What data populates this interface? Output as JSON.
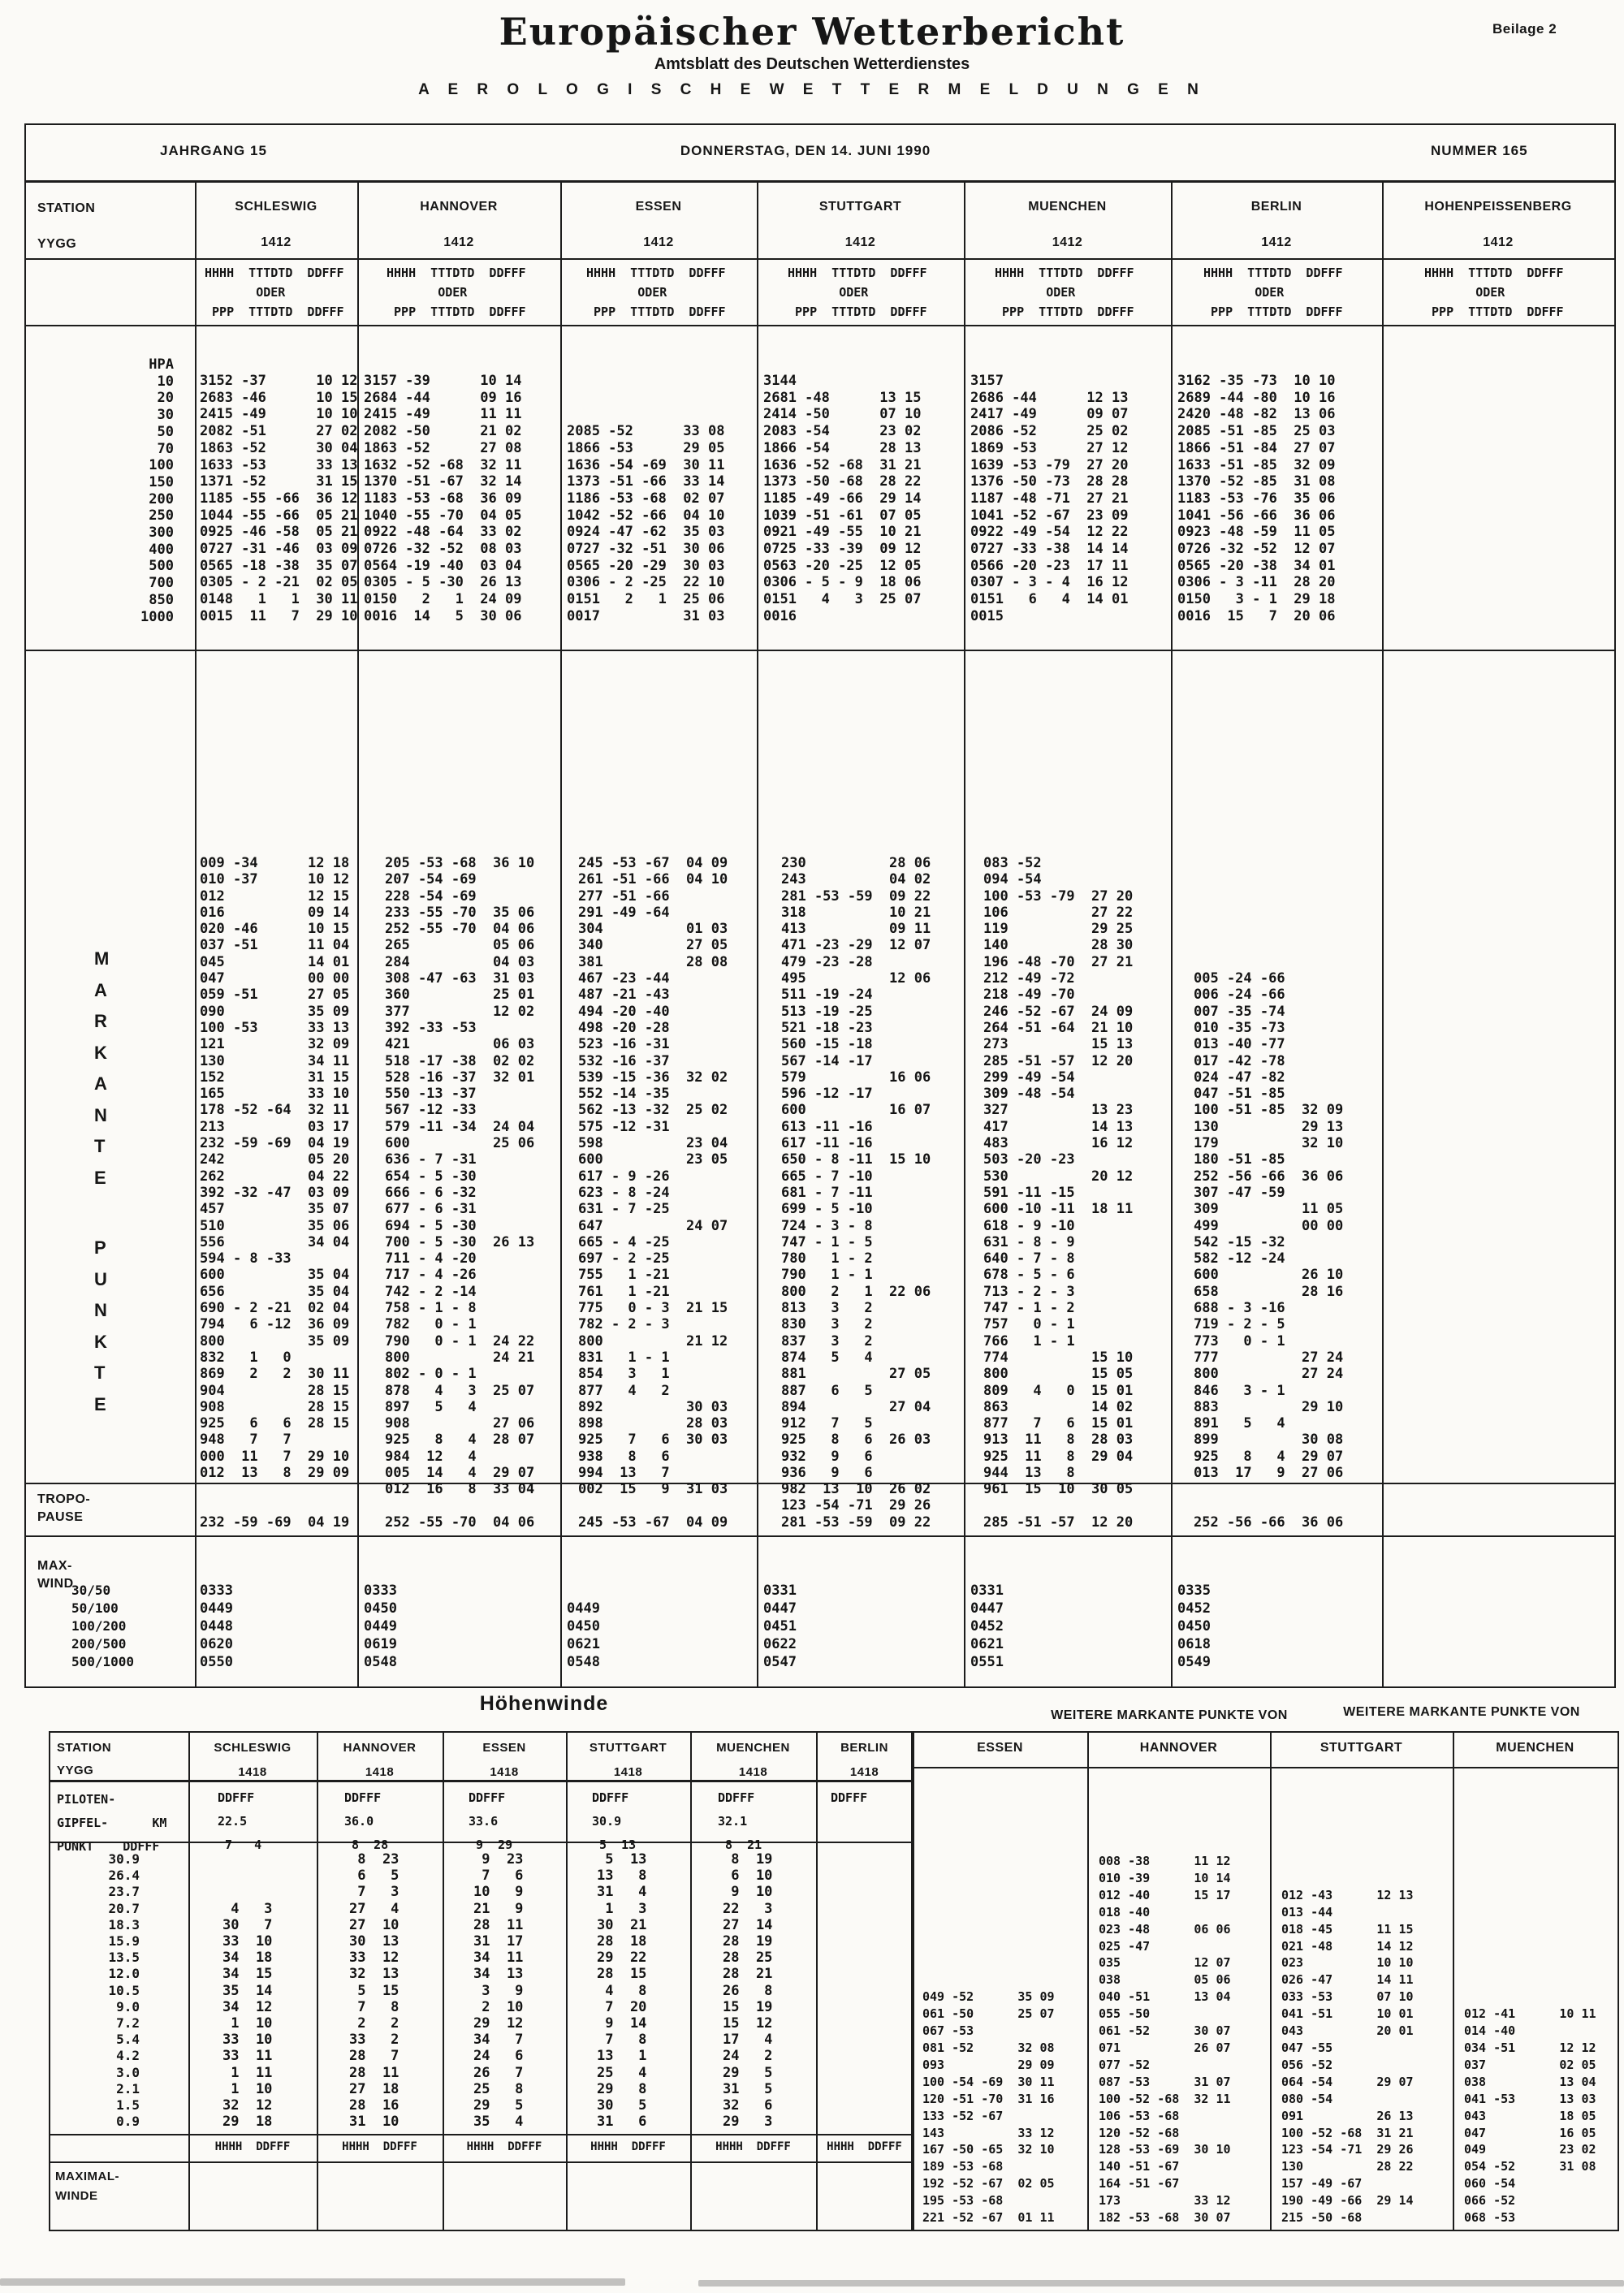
{
  "header": {
    "title": "Europäischer Wetterbericht",
    "subtitle": "Amtsblatt des Deutschen Wetterdienstes",
    "tagline": "A E R O L O G I S C H E   W E T T E R M E L D U N G E N",
    "beilage": "Beilage 2",
    "jahrgang": "JAHRGANG 15",
    "date": "DONNERSTAG, DEN 14. JUNI 1990",
    "nummer": "NUMMER 165"
  },
  "upper": {
    "station_label": "STATION",
    "yygg_label": "YYGG",
    "subheader_lines": [
      "HHHH  TTTDTD  DDFFF",
      "       ODER",
      " PPP  TTTDTD  DDFFF"
    ],
    "left_levels": [
      "HPA",
      "10",
      "20",
      "30",
      "50",
      "70",
      "100",
      "150",
      "200",
      "250",
      "300",
      "400",
      "500",
      "700",
      "850",
      "1000"
    ],
    "markante_letters_1": [
      "M",
      "A",
      "R",
      "K",
      "A",
      "N",
      "T",
      "E"
    ],
    "markante_letters_2": [
      "P",
      "U",
      "N",
      "K",
      "T",
      "E"
    ],
    "tropo_label_1": "TROPO-",
    "tropo_label_2": "PAUSE",
    "maxwind_label_1": "MAX-",
    "maxwind_label_2": "WIND",
    "maxwind_levels": [
      "30/50",
      "50/100",
      "100/200",
      "200/500",
      "500/1000"
    ],
    "stations": [
      {
        "name": "SCHLESWIG",
        "yygg": "1412",
        "hpa": [
          "3152 -37      10 12",
          "2683 -46      10 15",
          "2415 -49      10 10",
          "2082 -51      27 02",
          "1863 -52      30 04",
          "1633 -53      33 13",
          "1371 -52      31 15",
          "1185 -55 -66  36 12",
          "1044 -55 -66  05 21",
          "0925 -46 -58  05 21",
          "0727 -31 -46  03 09",
          "0565 -18 -38  35 07",
          "0305 - 2 -21  02 05",
          "0148   1   1  30 11",
          "0015  11   7  29 10"
        ],
        "markante": [
          "009 -34      12 18",
          "010 -37      10 12",
          "012          12 15",
          "016          09 14",
          "020 -46      10 15",
          "037 -51      11 04",
          "045          14 01",
          "047          00 00",
          "059 -51      27 05",
          "090          35 09",
          "100 -53      33 13",
          "121          32 09",
          "130          34 11",
          "152          31 15",
          "165          33 10",
          "178 -52 -64  32 11",
          "213          03 17",
          "232 -59 -69  04 19",
          "242          05 20",
          "262          04 22",
          "392 -32 -47  03 09",
          "457          35 07",
          "510          35 06",
          "556          34 04",
          "594 - 8 -33",
          "600          35 04",
          "656          35 04",
          "690 - 2 -21  02 04",
          "794   6 -12  36 09",
          "800          35 09",
          "832   1   0",
          "869   2   2  30 11",
          "904          28 15",
          "908          28 15",
          "925   6   6  28 15",
          "948   7   7",
          "000  11   7  29 10",
          "012  13   8  29 09"
        ],
        "tropo": [
          "",
          "232 -59 -69  04 19"
        ],
        "maxwind": [
          "0333",
          "0449",
          "0448",
          "0620",
          "0550"
        ]
      },
      {
        "name": "HANNOVER",
        "yygg": "1412",
        "hpa": [
          "3157 -39      10 14",
          "2684 -44      09 16",
          "2415 -49      11 11",
          "2082 -50      21 02",
          "1863 -52      27 08",
          "1632 -52 -68  32 11",
          "1370 -51 -67  32 14",
          "1183 -53 -68  36 09",
          "1040 -55 -70  04 05",
          "0922 -48 -64  33 02",
          "0726 -32 -52  08 03",
          "0564 -19 -40  03 04",
          "0305 - 5 -30  26 13",
          "0150   2   1  24 09",
          "0016  14   5  30 06"
        ],
        "markante": [
          "205 -53 -68  36 10",
          "207 -54 -69",
          "228 -54 -69",
          "233 -55 -70  35 06",
          "252 -55 -70  04 06",
          "265          05 06",
          "284          04 03",
          "308 -47 -63  31 03",
          "360          25 01",
          "377          12 02",
          "392 -33 -53",
          "421          06 03",
          "518 -17 -38  02 02",
          "528 -16 -37  32 01",
          "550 -13 -37",
          "567 -12 -33",
          "579 -11 -34  24 04",
          "600          25 06",
          "636 - 7 -31",
          "654 - 5 -30",
          "666 - 6 -32",
          "677 - 6 -31",
          "694 - 5 -30",
          "700 - 5 -30  26 13",
          "711 - 4 -20",
          "717 - 4 -26",
          "742 - 2 -14",
          "758 - 1 - 8",
          "782   0 - 1",
          "790   0 - 1  24 22",
          "800          24 21",
          "802 - 0 - 1",
          "878   4   3  25 07",
          "897   5   4",
          "908          27 06",
          "925   8   4  28 07",
          "984  12   4",
          "005  14   4  29 07",
          "012  16   8  33 04"
        ],
        "tropo": [
          "",
          "252 -55 -70  04 06"
        ],
        "maxwind": [
          "0333",
          "0450",
          "0449",
          "0619",
          "0548"
        ]
      },
      {
        "name": "ESSEN",
        "yygg": "1412",
        "hpa": [
          "",
          "",
          "",
          "2085 -52      33 08",
          "1866 -53      29 05",
          "1636 -54 -69  30 11",
          "1373 -51 -66  33 14",
          "1186 -53 -68  02 07",
          "1042 -52 -66  04 10",
          "0924 -47 -62  35 03",
          "0727 -32 -51  30 06",
          "0565 -20 -29  30 03",
          "0306 - 2 -25  22 10",
          "0151   2   1  25 06",
          "0017          31 03"
        ],
        "markante": [
          "245 -53 -67  04 09",
          "261 -51 -66  04 10",
          "277 -51 -66",
          "291 -49 -64",
          "304          01 03",
          "340          27 05",
          "381          28 08",
          "467 -23 -44",
          "487 -21 -43",
          "494 -20 -40",
          "498 -20 -28",
          "523 -16 -31",
          "532 -16 -37",
          "539 -15 -36  32 02",
          "552 -14 -35",
          "562 -13 -32  25 02",
          "575 -12 -31",
          "598          23 04",
          "600          23 05",
          "617 - 9 -26",
          "623 - 8 -24",
          "631 - 7 -25",
          "647          24 07",
          "665 - 4 -25",
          "697 - 2 -25",
          "755   1 -21",
          "761   1 -21",
          "775   0 - 3  21 15",
          "782 - 2 - 3",
          "800          21 12",
          "831   1 - 1",
          "854   3   1",
          "877   4   2",
          "892          30 03",
          "898          28 03",
          "925   7   6  30 03",
          "938   8   6",
          "994  13   7",
          "002  15   9  31 03"
        ],
        "tropo": [
          "",
          "245 -53 -67  04 09"
        ],
        "maxwind": [
          "",
          "0449",
          "0450",
          "0621",
          "0548"
        ]
      },
      {
        "name": "STUTTGART",
        "yygg": "1412",
        "hpa": [
          "3144",
          "2681 -48      13 15",
          "2414 -50      07 10",
          "2083 -54      23 02",
          "1866 -54      28 13",
          "1636 -52 -68  31 21",
          "1373 -50 -68  28 22",
          "1185 -49 -66  29 14",
          "1039 -51 -61  07 05",
          "0921 -49 -55  10 21",
          "0725 -33 -39  09 12",
          "0563 -20 -25  12 05",
          "0306 - 5 - 9  18 06",
          "0151   4   3  25 07",
          "0016"
        ],
        "markante": [
          "230          28 06",
          "243          04 02",
          "281 -53 -59  09 22",
          "318          10 21",
          "413          09 11",
          "471 -23 -29  12 07",
          "479 -23 -28",
          "495          12 06",
          "511 -19 -24",
          "513 -19 -25",
          "521 -18 -23",
          "560 -15 -18",
          "567 -14 -17",
          "579          16 06",
          "596 -12 -17",
          "600          16 07",
          "613 -11 -16",
          "617 -11 -16",
          "650 - 8 -11  15 10",
          "665 - 7 -10",
          "681 - 7 -11",
          "699 - 5 -10",
          "724 - 3 - 8",
          "747 - 1 - 5",
          "780   1 - 2",
          "790   1 - 1",
          "800   2   1  22 06",
          "813   3   2",
          "830   3   2",
          "837   3   2",
          "874   5   4",
          "881          27 05",
          "887   6   5",
          "894          27 04",
          "912   7   5",
          "925   8   6  26 03",
          "932   9   6",
          "936   9   6",
          "982  13  10  26 02"
        ],
        "tropo": [
          "123 -54 -71  29 26",
          "281 -53 -59  09 22"
        ],
        "maxwind": [
          "0331",
          "0447",
          "0451",
          "0622",
          "0547"
        ]
      },
      {
        "name": "MUENCHEN",
        "yygg": "1412",
        "hpa": [
          "3157",
          "2686 -44      12 13",
          "2417 -49      09 07",
          "2086 -52      25 02",
          "1869 -53      27 12",
          "1639 -53 -79  27 20",
          "1376 -50 -73  28 28",
          "1187 -48 -71  27 21",
          "1041 -52 -67  23 09",
          "0922 -49 -54  12 22",
          "0727 -33 -38  14 14",
          "0566 -20 -23  17 11",
          "0307 - 3 - 4  16 12",
          "0151   6   4  14 01",
          "0015"
        ],
        "markante": [
          "083 -52",
          "094 -54",
          "100 -53 -79  27 20",
          "106          27 22",
          "119          29 25",
          "140          28 30",
          "196 -48 -70  27 21",
          "212 -49 -72",
          "218 -49 -70",
          "246 -52 -67  24 09",
          "264 -51 -64  21 10",
          "273          15 13",
          "285 -51 -57  12 20",
          "299 -49 -54",
          "309 -48 -54",
          "327          13 23",
          "417          14 13",
          "483          16 12",
          "503 -20 -23",
          "530          20 12",
          "591 -11 -15",
          "600 -10 -11  18 11",
          "618 - 9 -10",
          "631 - 8 - 9",
          "640 - 7 - 8",
          "678 - 5 - 6",
          "713 - 2 - 3",
          "747 - 1 - 2",
          "757   0 - 1",
          "766   1 - 1",
          "774          15 10",
          "800          15 05",
          "809   4   0  15 01",
          "863          14 02",
          "877   7   6  15 01",
          "913  11   8  28 03",
          "925  11   8  29 04",
          "944  13   8",
          "961  15  10  30 05"
        ],
        "tropo": [
          "",
          "285 -51 -57  12 20"
        ],
        "maxwind": [
          "0331",
          "0447",
          "0452",
          "0621",
          "0551"
        ]
      },
      {
        "name": "BERLIN",
        "yygg": "1412",
        "hpa": [
          "3162 -35 -73  10 10",
          "2689 -44 -80  10 16",
          "2420 -48 -82  13 06",
          "2085 -51 -85  25 03",
          "1866 -51 -84  27 07",
          "1633 -51 -85  32 09",
          "1370 -52 -85  31 08",
          "1183 -53 -76  35 06",
          "1041 -56 -66  36 06",
          "0923 -48 -59  11 05",
          "0726 -32 -52  12 07",
          "0565 -20 -38  34 01",
          "0306 - 3 -11  28 20",
          "0150   3 - 1  29 18",
          "0016  15   7  20 06"
        ],
        "markante": [
          "",
          "",
          "",
          "",
          "",
          "",
          "",
          "005 -24 -66",
          "006 -24 -66",
          "007 -35 -74",
          "010 -35 -73",
          "013 -40 -77",
          "017 -42 -78",
          "024 -47 -82",
          "047 -51 -85",
          "100 -51 -85  32 09",
          "130          29 13",
          "179          32 10",
          "180 -51 -85",
          "252 -56 -66  36 06",
          "307 -47 -59",
          "309          11 05",
          "499          00 00",
          "542 -15 -32",
          "582 -12 -24",
          "600          26 10",
          "658          28 16",
          "688 - 3 -16",
          "719 - 2 - 5",
          "773   0 - 1",
          "777          27 24",
          "800          27 24",
          "846   3 - 1",
          "883          29 10",
          "891   5   4",
          "899          30 08",
          "925   8   4  29 07",
          "013  17   9  27 06"
        ],
        "tropo": [
          "",
          "252 -56 -66  36 06"
        ],
        "maxwind": [
          "0335",
          "0452",
          "0450",
          "0618",
          "0549"
        ]
      },
      {
        "name": "HOHENPEISSENBERG",
        "yygg": "1412",
        "hpa": [],
        "markante": [],
        "tropo": [],
        "maxwind": []
      }
    ]
  },
  "hoehenwinde": {
    "title": "Höhenwinde",
    "station_label": "STATION",
    "yygg_label": "YYGG",
    "piloten_label_lines": [
      "PILOTEN-",
      "GIPFEL-      KM",
      "PUNKT    DDFFF"
    ],
    "altitudes": [
      "30.9",
      "26.4",
      "23.7",
      "20.7",
      "18.3",
      "15.9",
      "13.5",
      "12.0",
      "10.5",
      "9.0",
      "7.2",
      "5.4",
      "4.2",
      "3.0",
      "2.1",
      "1.5",
      "0.9"
    ],
    "maximal_label_1": "MAXIMAL-",
    "maximal_label_2": "WINDE",
    "hhhh_ddfff": "HHHH  DDFFF",
    "stations": [
      {
        "name": "SCHLESWIG",
        "yygg": "1418",
        "piloten": [
          "DDFFF",
          "22.5",
          " 7   4"
        ],
        "winds": [
          "",
          "",
          "",
          " 4   3",
          "30   7",
          "33  10",
          "34  18",
          "34  15",
          "35  14",
          "34  12",
          " 1  10",
          "33  10",
          "33  11",
          " 1  11",
          " 1  10",
          "32  12",
          "29  18"
        ]
      },
      {
        "name": "HANNOVER",
        "yygg": "1418",
        "piloten": [
          "DDFFF",
          "36.0",
          " 8  28"
        ],
        "winds": [
          " 8  23",
          " 6   5",
          " 7   3",
          "27   4",
          "27  10",
          "30  13",
          "33  12",
          "32  13",
          " 5  15",
          " 7   8",
          " 2   2",
          "33   2",
          "28   7",
          "28  11",
          "27  18",
          "28  16",
          "31  10"
        ]
      },
      {
        "name": "ESSEN",
        "yygg": "1418",
        "piloten": [
          "DDFFF",
          "33.6",
          " 9  29"
        ],
        "winds": [
          " 9  23",
          " 7   6",
          "10   9",
          "21   9",
          "28  11",
          "31  17",
          "34  11",
          "34  13",
          " 3   9",
          " 2  10",
          "29  12",
          "34   7",
          "24   6",
          "26   7",
          "25   8",
          "29   5",
          "35   4"
        ]
      },
      {
        "name": "STUTTGART",
        "yygg": "1418",
        "piloten": [
          "DDFFF",
          "30.9",
          " 5  13"
        ],
        "winds": [
          " 5  13",
          "13   8",
          "31   4",
          " 1   3",
          "30  21",
          "28  18",
          "29  22",
          "28  15",
          " 4   8",
          " 7  20",
          " 9  14",
          " 7   8",
          "13   1",
          "25   4",
          "29   8",
          "30   5",
          "31   6"
        ]
      },
      {
        "name": "MUENCHEN",
        "yygg": "1418",
        "piloten": [
          "DDFFF",
          "32.1",
          " 8  21"
        ],
        "winds": [
          " 8  19",
          " 6  10",
          " 9  10",
          "22   3",
          "27  14",
          "28  19",
          "28  25",
          "28  21",
          "26   8",
          "15  19",
          "15  12",
          "17   4",
          "24   2",
          "29   5",
          "31   5",
          "32   6",
          "29   3"
        ]
      },
      {
        "name": "BERLIN",
        "yygg": "1418",
        "piloten": [
          "DDFFF"
        ],
        "winds": []
      }
    ]
  },
  "weitere": {
    "title_left": "WEITERE MARKANTE PUNKTE VON",
    "title_right": "WEITERE MARKANTE PUNKTE VON",
    "columns": [
      {
        "name": "ESSEN",
        "lines": [
          "",
          "",
          "",
          "",
          "",
          "",
          "",
          "",
          "049 -52      35 09",
          "061 -50      25 07",
          "067 -53",
          "081 -52      32 08",
          "093          29 09",
          "100 -54 -69  30 11",
          "120 -51 -70  31 16",
          "133 -52 -67",
          "143          33 12",
          "167 -50 -65  32 10",
          "189 -53 -68",
          "192 -52 -67  02 05",
          "195 -53 -68",
          "221 -52 -67  01 11"
        ]
      },
      {
        "name": "HANNOVER",
        "lines": [
          "008 -38      11 12",
          "010 -39      10 14",
          "012 -40      15 17",
          "018 -40",
          "023 -48      06 06",
          "025 -47",
          "035          12 07",
          "038          05 06",
          "040 -51      13 04",
          "055 -50",
          "061 -52      30 07",
          "071          26 07",
          "077 -52",
          "087 -53      31 07",
          "100 -52 -68  32 11",
          "106 -53 -68",
          "120 -52 -68",
          "128 -53 -69  30 10",
          "140 -51 -67",
          "164 -51 -67",
          "173          33 12",
          "182 -53 -68  30 07"
        ]
      },
      {
        "name": "STUTTGART",
        "lines": [
          "",
          "",
          "012 -43      12 13",
          "013 -44",
          "018 -45      11 15",
          "021 -48      14 12",
          "023          10 10",
          "026 -47      14 11",
          "033 -53      07 10",
          "041 -51      10 01",
          "043          20 01",
          "047 -55",
          "056 -52",
          "064 -54      29 07",
          "080 -54",
          "091          26 13",
          "100 -52 -68  31 21",
          "123 -54 -71  29 26",
          "130          28 22",
          "157 -49 -67",
          "190 -49 -66  29 14",
          "215 -50 -68"
        ]
      },
      {
        "name": "MUENCHEN",
        "lines": [
          "",
          "",
          "",
          "",
          "",
          "",
          "",
          "",
          "",
          "012 -41      10 11",
          "014 -40",
          "034 -51      12 12",
          "037          02 05",
          "038          13 04",
          "041 -53      13 03",
          "043          18 05",
          "047          16 05",
          "049          23 02",
          "054 -52      31 08",
          "060 -54",
          "066 -52",
          "068 -53"
        ]
      }
    ]
  }
}
